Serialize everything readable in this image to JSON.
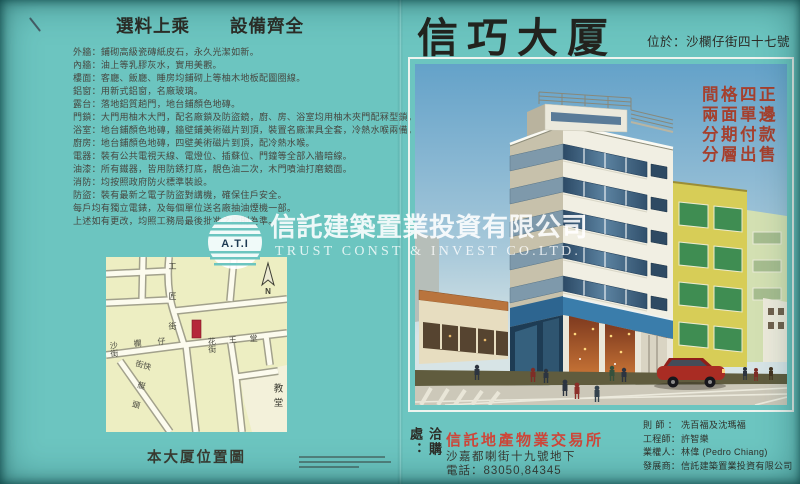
{
  "colors": {
    "background_teal": "#6cc5c0",
    "slogan_red": "#a5402e",
    "agency_red": "#ce4639",
    "map_yellow": "#edeec2",
    "marker_red": "#b5273a",
    "watermark_white": "#ffffff"
  },
  "left_panel": {
    "title_1": "選料上乘",
    "title_2": "設備齊全",
    "features": [
      "外牆：鋪砌高級瓷磚紙皮石，永久光潔如新。",
      "內牆：油上等乳膠灰水，實用美觀。",
      "樓面：客廳、飯廳、睡房均鋪砌上等柚木地板配圖圈線。",
      "鋁窗：用新式鋁窗，名廠玻璃。",
      "露台：落地鋁質趟門，地台鋪顏色地磚。",
      "門鎖：大門用柚木大門，配名廠鎖及防盜鏡，廚、房、浴室均用柚木夾門配冧型鎖。",
      "浴室：地台鋪顏色地磚，牆壁鋪美術磁片到頂，裝置名廠潔具全套，冷熱水喉兩備。",
      "廚房：地台鋪顏色地磚，四壁美術磁片到頂，配冷熱水喉。",
      "電器：裝有公共電視天線、電燈位、插蘇位、門鐘等全部入牆暗線。",
      "油漆：所有鐵器，皆用防銹打底，靚色油二次，木門噴油打磨鏡面。",
      "消防：均按照政府防火標準裝設。",
      "防盜：裝有最新之電子防盜對講機，確保住戶安全。",
      "每戶均有獨立電錶，及每個單位送名廠抽油煙機一部。",
      "上述如有更改，均照工務局最後批准之圖則為準。"
    ],
    "map": {
      "street_top": "工匠街",
      "street_main": "沙欄仔街",
      "street_right": "花王堂街",
      "street_diagonal": "快艇頭街",
      "church": "教堂",
      "compass": "N",
      "caption": "本大厦位置圖"
    }
  },
  "watermark": {
    "logo_text": "A.T.I",
    "company_cn": "信託建築置業投資有限公司",
    "company_en": "TRUST CONST & INVEST CO.LTD."
  },
  "right_panel": {
    "title": "信巧大厦",
    "location": "位於：沙欄仔街四十七號",
    "slogan_lines": [
      "間格四正",
      "兩面單邊",
      "分期付款",
      "分層出售"
    ],
    "sales": {
      "contact_label": "洽購處：",
      "agency": "信託地產物業交易所",
      "address": "沙嘉都喇街十九號地下",
      "phone": "電話：83050,84345"
    },
    "credits": [
      {
        "label": "則師：",
        "value": "冼百福及沈瑪福"
      },
      {
        "label": "工程師：",
        "value": "許智樂"
      },
      {
        "label": "業權人：",
        "value": "林偉 (Pedro Chiang)"
      },
      {
        "label": "發展商：",
        "value": "信託建築置業投資有限公司"
      }
    ]
  }
}
